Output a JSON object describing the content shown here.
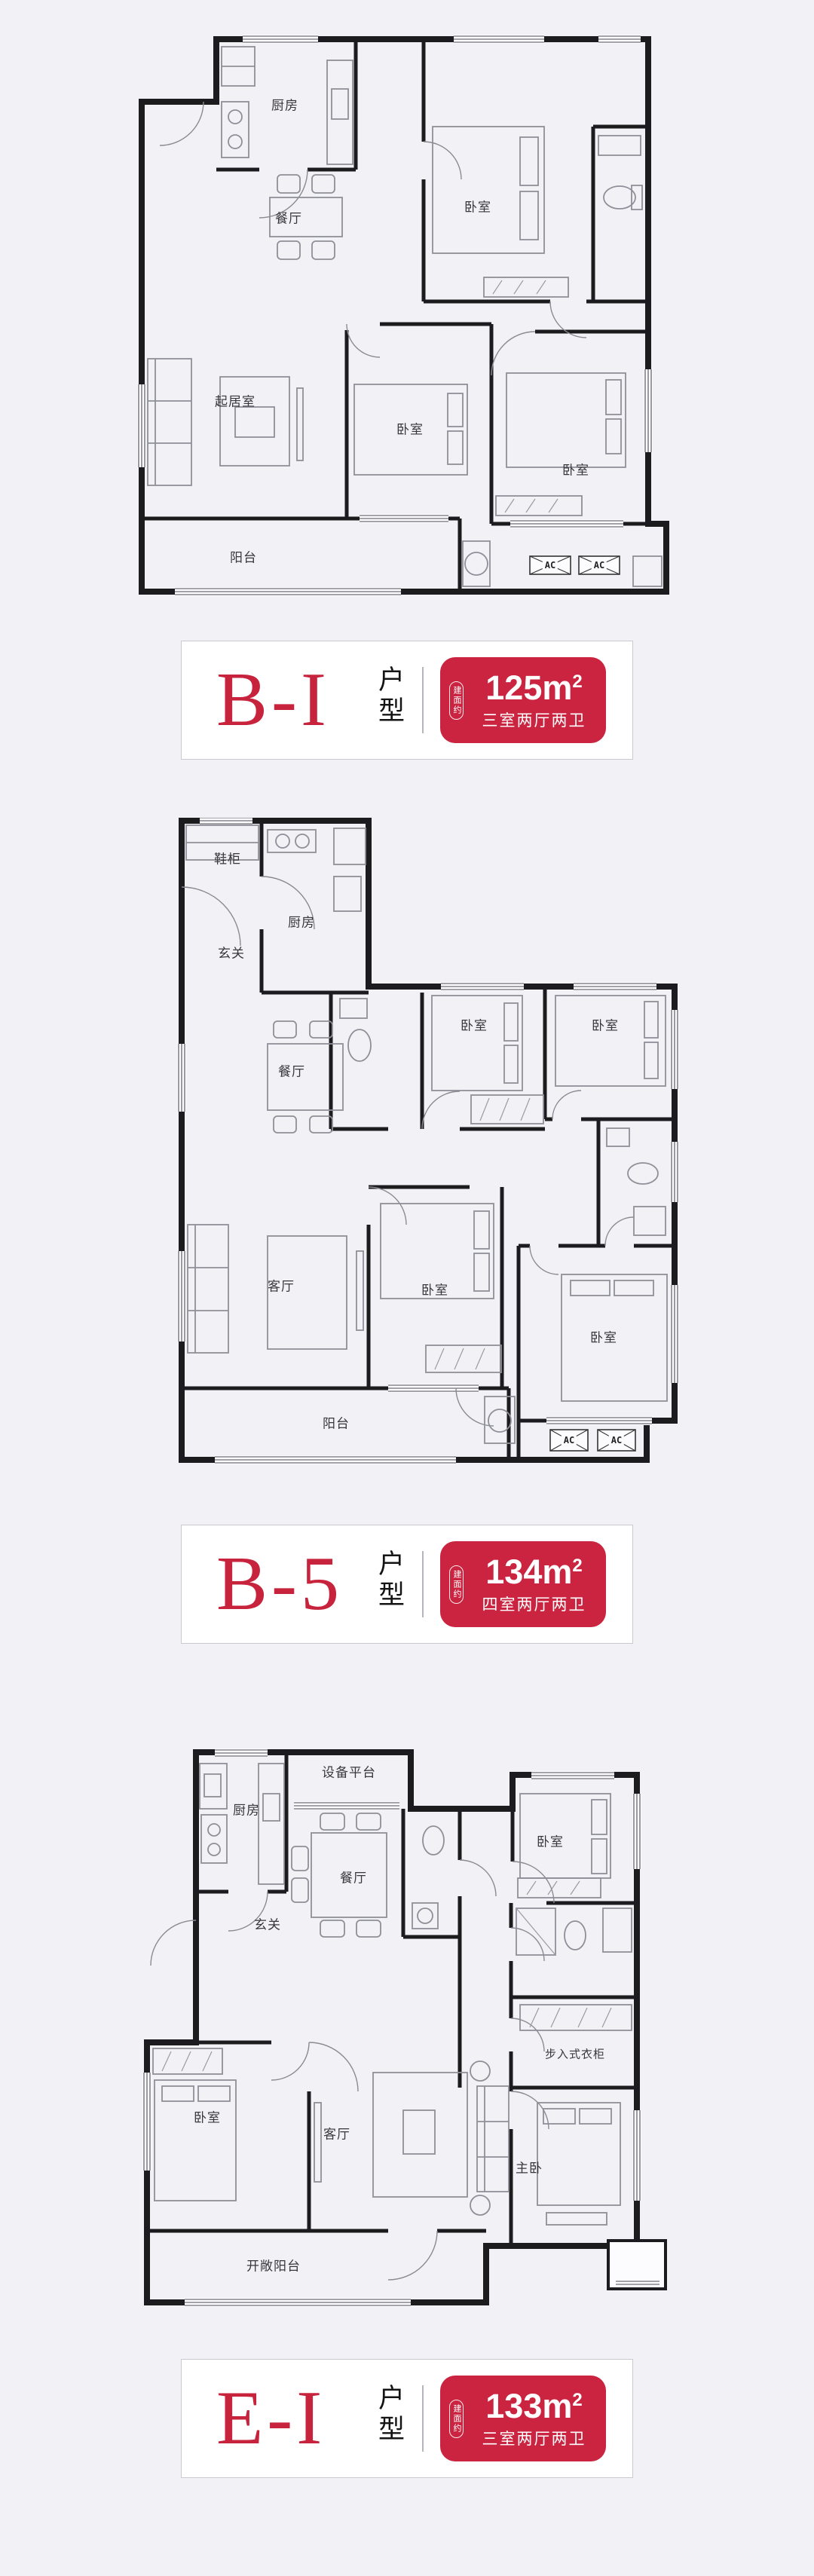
{
  "page": {
    "background": "#f2f2f6",
    "card_border": "#c9cad1",
    "accent_red": "#cb2440",
    "wall_color": "#1c1c1e"
  },
  "plans": [
    {
      "badge": {
        "name": "B-I",
        "type_label": "户型",
        "area_tag": "建面约",
        "area_main": "125m",
        "area_sup": "2",
        "layout_text": "三室两厅两卫"
      },
      "rooms": [
        {
          "label": "厨房"
        },
        {
          "label": "餐厅"
        },
        {
          "label": "卧室"
        },
        {
          "label": "起居室"
        },
        {
          "label": "卧室"
        },
        {
          "label": "卧室"
        },
        {
          "label": "阳台"
        }
      ],
      "ac": [
        "AC",
        "AC"
      ]
    },
    {
      "badge": {
        "name": "B-5",
        "type_label": "户型",
        "area_tag": "建面约",
        "area_main": "134m",
        "area_sup": "2",
        "layout_text": "四室两厅两卫"
      },
      "rooms": [
        {
          "label": "鞋柜"
        },
        {
          "label": "厨房"
        },
        {
          "label": "玄关"
        },
        {
          "label": "餐厅"
        },
        {
          "label": "卧室"
        },
        {
          "label": "卧室"
        },
        {
          "label": "客厅"
        },
        {
          "label": "卧室"
        },
        {
          "label": "卧室"
        },
        {
          "label": "阳台"
        }
      ],
      "ac": [
        "AC",
        "AC"
      ]
    },
    {
      "badge": {
        "name": "E-I",
        "type_label": "户型",
        "area_tag": "建面约",
        "area_main": "133m",
        "area_sup": "2",
        "layout_text": "三室两厅两卫"
      },
      "rooms": [
        {
          "label": "设备平台"
        },
        {
          "label": "厨房"
        },
        {
          "label": "餐厅"
        },
        {
          "label": "玄关"
        },
        {
          "label": "卧室"
        },
        {
          "label": "步入式衣柜"
        },
        {
          "label": "卧室"
        },
        {
          "label": "客厅"
        },
        {
          "label": "主卧"
        },
        {
          "label": "开敞阳台"
        }
      ]
    }
  ]
}
